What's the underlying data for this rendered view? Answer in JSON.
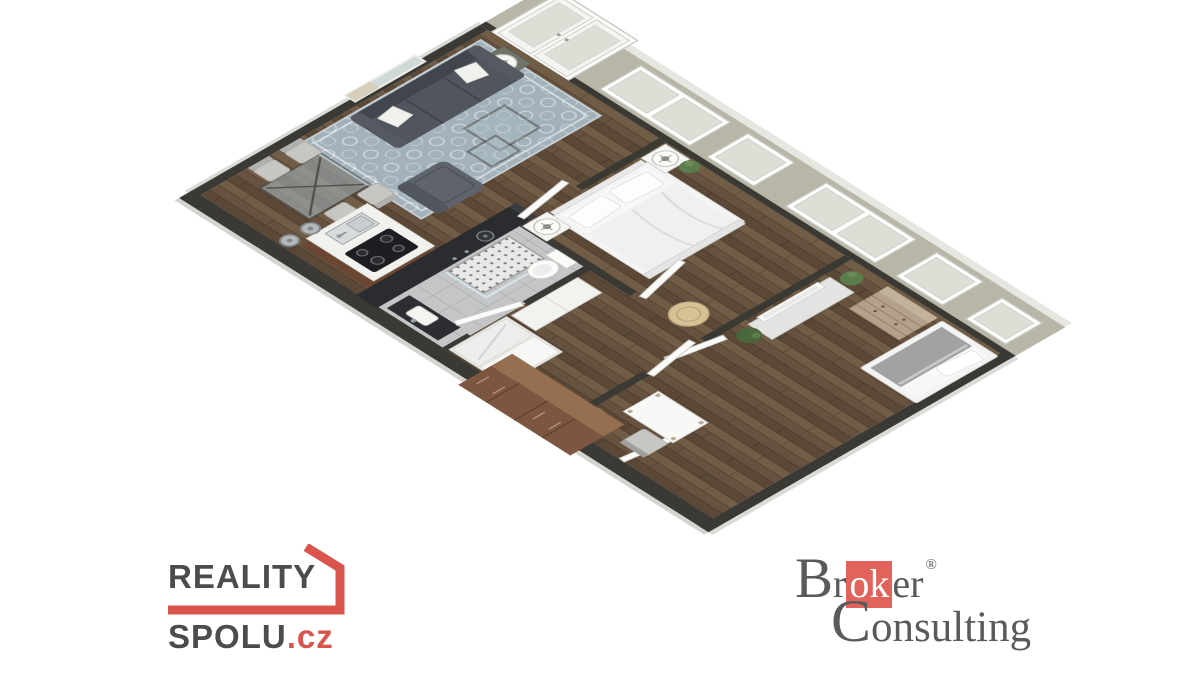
{
  "canvas": {
    "width": 1200,
    "height": 675
  },
  "colors": {
    "background": "#ffffff",
    "wood": "#66523f",
    "wood_light": "#7a644d",
    "wood_dark": "#52402f",
    "wall_band": "#b8b7a7",
    "band_rim": "#e7e7e2",
    "wall_dark": "#3a3934",
    "tile": "#c3c5c6",
    "rug": "#a3b1ba",
    "rug_line": "#ccd5d9",
    "sofa": "#51555d",
    "sofa_dark": "#41454c",
    "armchair": "#5e636c",
    "chair": "#c6c6c3",
    "glass": "#a9bcc4",
    "island_top": "#f1f1ee",
    "island_base": "#6b4733",
    "cooktop": "#1e1e22",
    "monolith": "#2a2c2f",
    "white_furniture": "#f4f4f1",
    "bed_white": "#f3f4f3",
    "blanket": "#a2a2a0",
    "dresser": "#b3a189",
    "wardrobe_brown": "#7c5640",
    "wardrobe_brown_top": "#966e50",
    "pouf": "#d7c297",
    "plant": "#5d7c4c",
    "plant_dark": "#49663c",
    "door": "#fbfbf9",
    "door_edge": "#c9c9c3",
    "window_glass": "#dcdfd6",
    "metal": "#9aa0a3",
    "logo_red": "#d9544d",
    "logo_gray": "#4b4c4e",
    "broker_red": "#e2625c",
    "broker_gray": "#595a5c"
  },
  "branding": {
    "reality_spolu": {
      "line1": "REALITY",
      "line2": "SPOLU",
      "tld": ".cz"
    },
    "broker_consulting": {
      "part1": "Br",
      "boxed": "ok",
      "part2": "er",
      "registered": "®",
      "line2": "Consulting"
    }
  },
  "floorplan": {
    "type": "3d-isometric-apartment-render",
    "rooms": [
      {
        "name": "living-room",
        "items": [
          "sofa",
          "throw-pillows",
          "nesting-coffee-tables",
          "armchair",
          "area-rug",
          "wall-art",
          "side-table-with-lamp",
          "dining-table",
          "dining-chairs"
        ]
      },
      {
        "name": "kitchen",
        "items": [
          "island-counter",
          "sink",
          "cooktop",
          "bar-stools",
          "tall-dark-cabinets"
        ]
      },
      {
        "name": "bathroom",
        "items": [
          "walk-in-shower",
          "shower-head",
          "toilet",
          "vanity-with-sink",
          "tile-floor"
        ]
      },
      {
        "name": "master-bedroom",
        "items": [
          "double-bed",
          "nightstand",
          "nightstand",
          "table-lamps",
          "plant",
          "round-pouf"
        ]
      },
      {
        "name": "hallway",
        "items": [
          "sliding-wardrobe",
          "wardrobe",
          "doors"
        ]
      },
      {
        "name": "second-bedroom",
        "items": [
          "single-bed",
          "dresser",
          "tv-panel",
          "tv-cabinet",
          "desk",
          "chair",
          "plants",
          "large-brown-wardrobe"
        ]
      }
    ],
    "exterior": {
      "french_doors": 1,
      "windows": 5,
      "far_wall_style": "flattened-green-gray-band"
    }
  }
}
